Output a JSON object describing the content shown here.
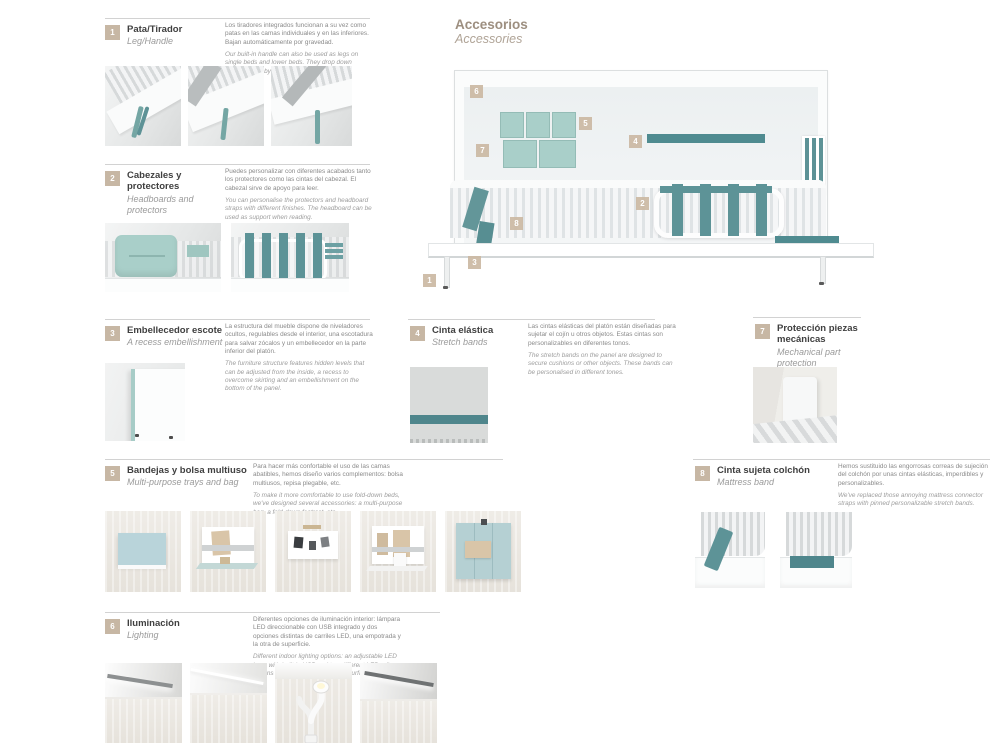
{
  "page": {
    "title_es": "Accesorios",
    "title_en": "Accessories"
  },
  "sections": [
    {
      "number": "1",
      "title_es": "Pata/Tirador",
      "title_en": "Leg/Handle",
      "text_es": "Los tiradores integrados funcionan a su vez como patas en las camas individuales y en las inferiores. Bajan automáticamente por gravedad.",
      "text_en": "Our built-in handle can also be used as legs on single beds and lower beds. They drop down automatically by gravity."
    },
    {
      "number": "2",
      "title_es": "Cabezales y protectores",
      "title_en": "Headboards and protectors",
      "text_es": "Puedes personalizar con diferentes acabados tanto los protectores como las cintas del cabezal. El cabezal sirve de apoyo para leer.",
      "text_en": "You can personalise the protectors and headboard straps with different finishes. The headboard can be used as support when reading."
    },
    {
      "number": "3",
      "title_es": "Embellecedor escote",
      "title_en": "A recess embellishment",
      "text_es": "La estructura del mueble dispone de niveladores ocultos, regulables desde el interior, una escotadura para salvar zócalos y un embellecedor en la parte inferior del platón.",
      "text_en": "The furniture structure features hidden levels that can be adjusted from the inside, a recess to overcome skirting and an embellishment on the bottom of the panel."
    },
    {
      "number": "4",
      "title_es": "Cinta elástica",
      "title_en": "Stretch bands",
      "text_es": "Las cintas elásticas del platón están diseñadas para sujetar el cojín u otros objetos. Estas cintas son personalizables en diferentes tonos.",
      "text_en": "The stretch bands on the panel are designed to secure cushions or other objects. These bands can be personalised in different tones."
    },
    {
      "number": "5",
      "title_es": "Bandejas y bolsa multiuso",
      "title_en": "Multi-purpose trays and bag",
      "text_es": "Para hacer más confortable el uso de las camas abatibles, hemos diseño varios complementos: bolsa multiusos, repisa plegable, etc.",
      "text_en": "To make it more comfortable to use fold-down beds, we've designed several accessories: a multi-purpose bag, a fold-down footrest, etc."
    },
    {
      "number": "6",
      "title_es": "Iluminación",
      "title_en": "Lighting",
      "text_es": "Diferentes opciones de iluminación interior: lámpara LED direccionable con USB integrado y dos opciones distintas de carriles LED, una empotrada y la otra de superficie.",
      "text_en": "Different indoor lighting options: an adjustable LED lamp with built-in USB and two different LED rail options - one built-in and another surface option."
    },
    {
      "number": "7",
      "title_es": "Protección piezas mecánicas",
      "title_en": "Mechanical part protection",
      "text_es": "",
      "text_en": ""
    },
    {
      "number": "8",
      "title_es": "Cinta sujeta colchón",
      "title_en": "Mattress band",
      "text_es": "Hemos sustituido las engorrosas correas de sujeción del colchón por unas cintas elásticas, imperdibles y personalizables.",
      "text_en": "We've replaced those annoying mattress connector straps with pinned personalizable stretch bands."
    }
  ],
  "diagram": {
    "markers": [
      {
        "label": "6"
      },
      {
        "label": "5"
      },
      {
        "label": "7"
      },
      {
        "label": "4"
      },
      {
        "label": "2"
      },
      {
        "label": "8"
      },
      {
        "label": "3"
      },
      {
        "label": "1"
      }
    ]
  },
  "colors": {
    "accent_teal": "#5d9397",
    "dark_teal": "#4f8b90",
    "light_teal": "#a9cfc9",
    "marker_beige": "#c7b7a4",
    "title_brown": "#9d8f80"
  }
}
